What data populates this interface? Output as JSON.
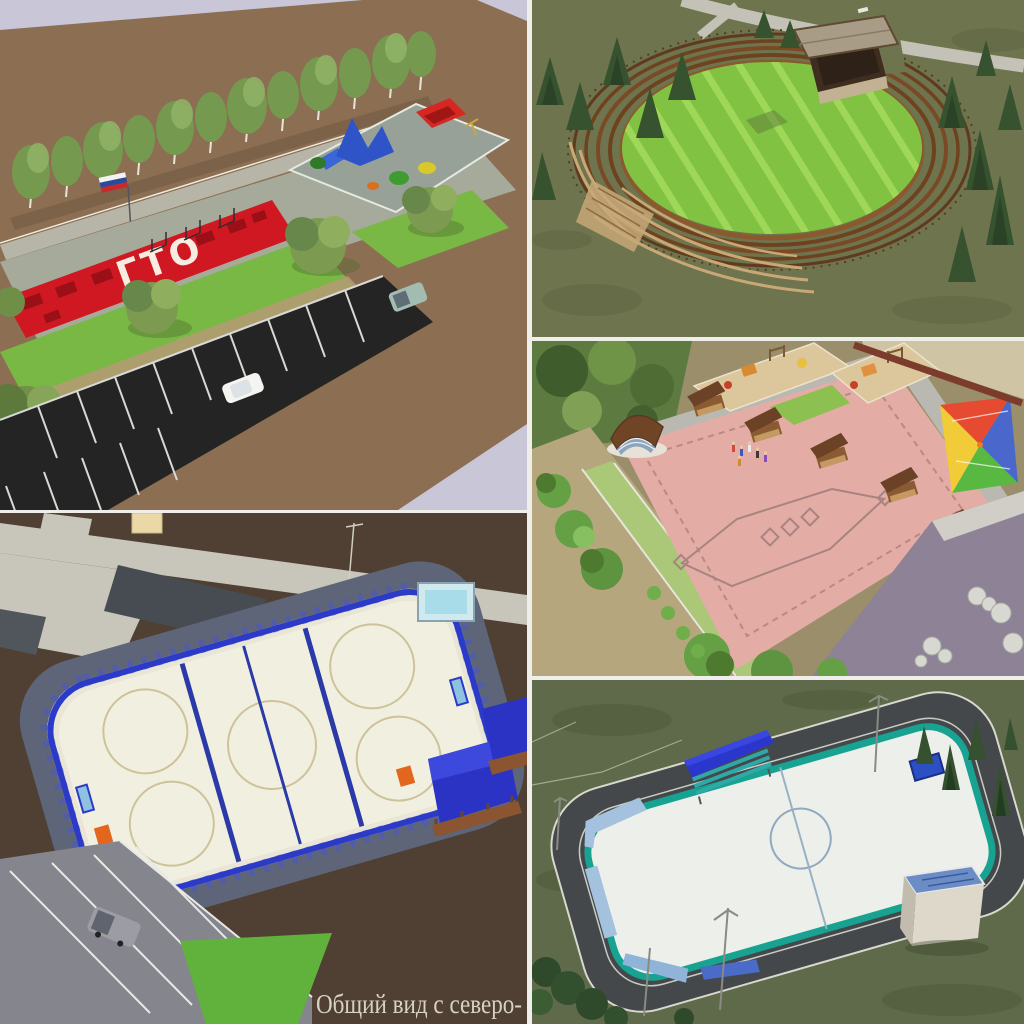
{
  "collage": {
    "caption": "Общий вид с северо-",
    "panel_count": 5
  },
  "panels": {
    "fitness_park": {
      "description": "Воркаут-парк: красная площадка ГТО, детский городок, аллея берёз, парковка",
      "court_marking": "ГТО"
    },
    "amphitheater": {
      "description": "Круглая поляна с деревянным амфитеатром и сценой"
    },
    "plaza": {
      "description": "Площадь с эстрадой-ракушкой, качелями-перголами и детскими площадками"
    },
    "hockey_rink_blue": {
      "description": "Хоккейная коробка с трибунами, табло и парковкой"
    },
    "hockey_rink_teal": {
      "description": "Хоккейная коробка с беговой дорожкой и хозблоком"
    }
  },
  "palette": {
    "sky_lavender": "#c9c6d7",
    "ground_brown": "#8c6e52",
    "dark_soil": "#503f33",
    "court_red": "#d01822",
    "lawn_green": "#79b845",
    "olive_grass": "#6e754e",
    "stripe_lawn": "#82c243",
    "wood_brown": "#7a4a26",
    "plaza_pink": "#e3aca4",
    "rink_blue": "#2c3ac8",
    "rink_teal": "#18a291",
    "ice_white": "#f0efe2",
    "asphalt_black": "#242424",
    "path_gray": "#c8c5bb",
    "caption_text": "#d8d2c6"
  }
}
